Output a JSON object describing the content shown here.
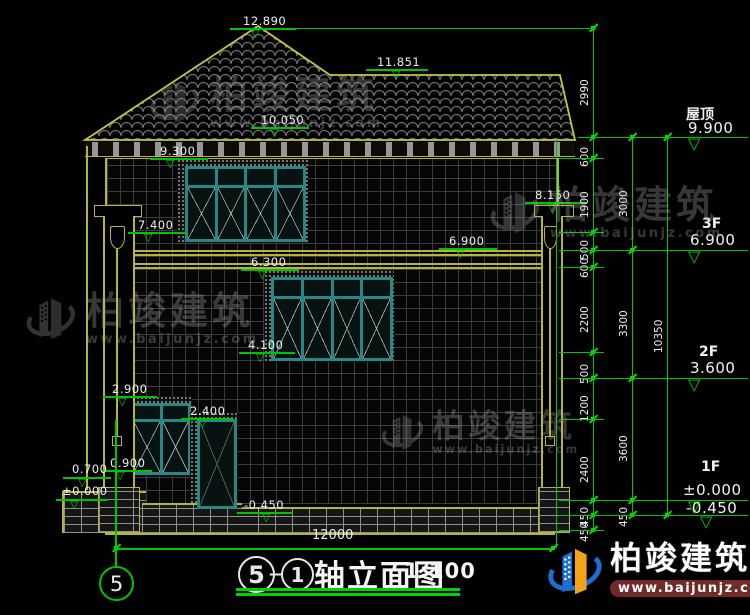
{
  "meta": {
    "axis_start": "5",
    "axis_end": "1",
    "separator": "—",
    "title": "轴立面图",
    "scale": "1:100",
    "sheet_axis_bubble": "5"
  },
  "brand": {
    "name": "柏竣建筑",
    "url": "www.baijunjz.com"
  },
  "colors": {
    "line_yellow": "#b5b53c",
    "annotation_green": "#00c400",
    "window_teal": "#2a8585",
    "logo_blue": "#1b6fd0",
    "logo_orange": "#f5a21b",
    "url_bar_maroon": "#702a2a"
  },
  "right_panel": {
    "floors": [
      {
        "name": "屋顶",
        "value": "9.900"
      },
      {
        "name": "3F",
        "value": "6.900"
      },
      {
        "name": "2F",
        "value": "3.600"
      },
      {
        "name": "1F",
        "value": "±0.000"
      }
    ],
    "ground_value": "-0.450"
  },
  "dimensions": {
    "chains": [
      {
        "values": [
          "2990",
          "600",
          "1900",
          "500",
          "600",
          "2200",
          "500",
          "1200",
          "2400",
          "450",
          "450"
        ]
      },
      {
        "values": [
          "3000",
          "3300",
          "3600",
          "450"
        ]
      },
      {
        "values": [
          "10350"
        ]
      }
    ],
    "total_width": "12000"
  },
  "elevation_marks": [
    "12.890",
    "11.851",
    "10.050",
    "9.300",
    "8.150",
    "7.400",
    "6.900",
    "6.300",
    "4.100",
    "2.900",
    "2.400",
    "0.900",
    "0.700",
    "±0.000",
    "-0.450"
  ]
}
